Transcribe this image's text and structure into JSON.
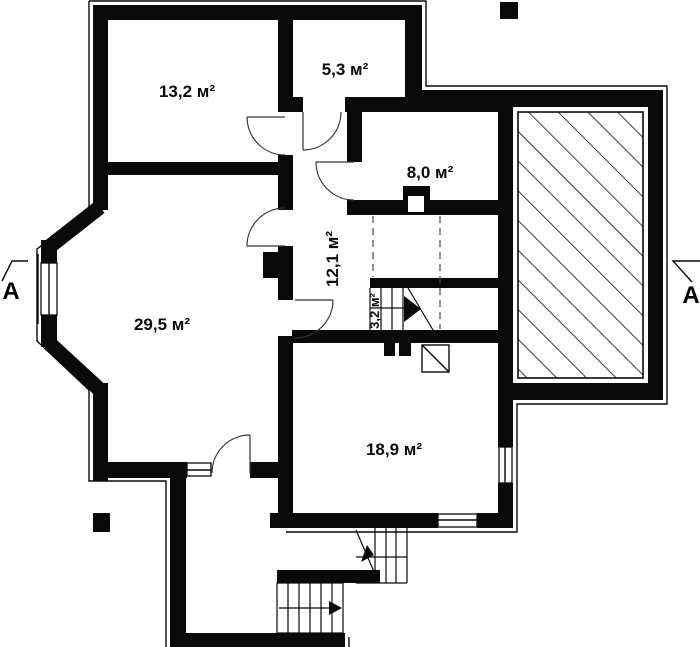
{
  "plan": {
    "title": "floor-plan",
    "rooms": [
      {
        "id": "room-13-2",
        "area_label": "13,2 м²"
      },
      {
        "id": "room-5-3",
        "area_label": "5,3 м²"
      },
      {
        "id": "room-8-0",
        "area_label": "8,0 м²"
      },
      {
        "id": "room-12-1",
        "area_label": "12,1 м²"
      },
      {
        "id": "room-3-2",
        "area_label": "3,2 м²"
      },
      {
        "id": "room-29-5",
        "area_label": "29,5 м²"
      },
      {
        "id": "room-18-9",
        "area_label": "18,9 м²"
      }
    ],
    "section_markers": {
      "left": "A",
      "right": "A"
    },
    "colors": {
      "wall": "#0a0a0a",
      "background": "#ffffff"
    }
  }
}
